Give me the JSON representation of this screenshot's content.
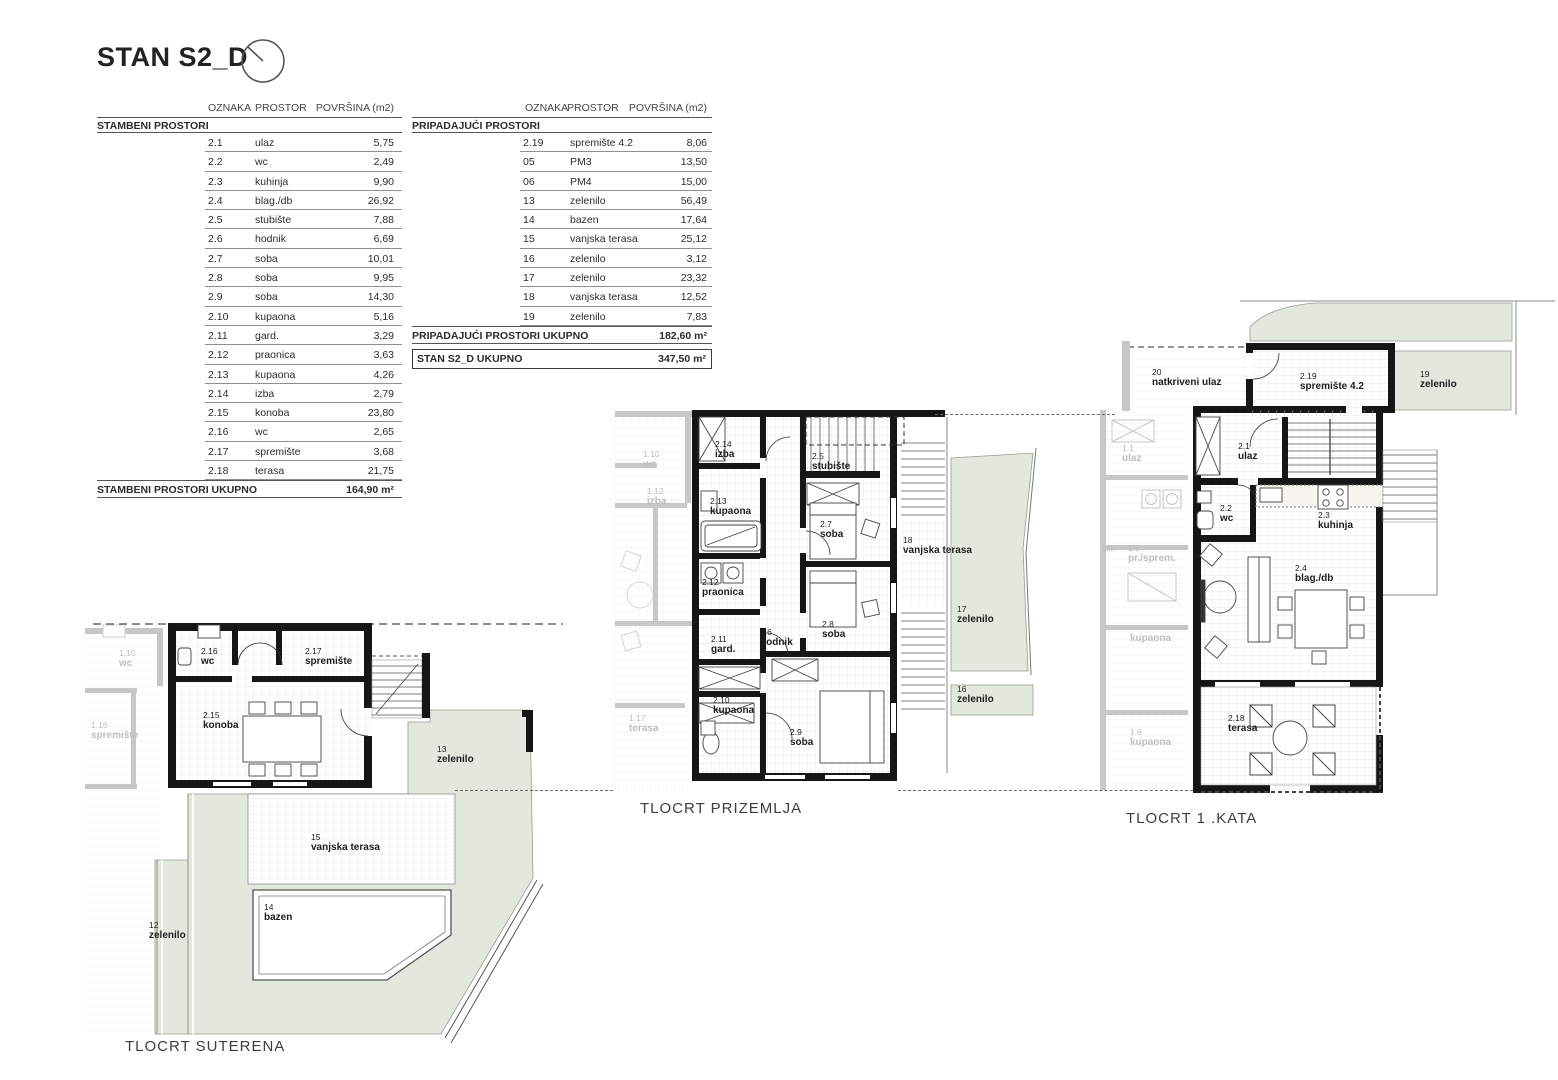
{
  "page": {
    "title": "STAN S2_D"
  },
  "tables": {
    "headers": {
      "oznaka": "OZNAKA",
      "prostor": "PROSTOR",
      "povrsina": "POVRŠINA (m2)"
    },
    "left": {
      "section": "STAMBENI PROSTORI",
      "rows": [
        [
          "2.1",
          "ulaz",
          "5,75"
        ],
        [
          "2.2",
          "wc",
          "2,49"
        ],
        [
          "2.3",
          "kuhinja",
          "9,90"
        ],
        [
          "2.4",
          "blag./db",
          "26,92"
        ],
        [
          "2.5",
          "stubište",
          "7,88"
        ],
        [
          "2.6",
          "hodnik",
          "6,69"
        ],
        [
          "2.7",
          "soba",
          "10,01"
        ],
        [
          "2.8",
          "soba",
          "9,95"
        ],
        [
          "2.9",
          "soba",
          "14,30"
        ],
        [
          "2.10",
          "kupaona",
          "5,16"
        ],
        [
          "2.11",
          "gard.",
          "3,29"
        ],
        [
          "2.12",
          "praonica",
          "3,63"
        ],
        [
          "2.13",
          "kupaona",
          "4,26"
        ],
        [
          "2.14",
          "izba",
          "2,79"
        ],
        [
          "2.15",
          "konoba",
          "23,80"
        ],
        [
          "2.16",
          "wc",
          "2,65"
        ],
        [
          "2.17",
          "spremište",
          "3,68"
        ],
        [
          "2.18",
          "terasa",
          "21,75"
        ]
      ],
      "total_label": "STAMBENI PROSTORI UKUPNO",
      "total_value": "164,90 m²"
    },
    "right": {
      "section": "PRIPADAJUĆI PROSTORI",
      "rows": [
        [
          "2.19",
          "spremište 4.2",
          "8,06"
        ],
        [
          "05",
          "PM3",
          "13,50"
        ],
        [
          "06",
          "PM4",
          "15,00"
        ],
        [
          "13",
          "zelenilo",
          "56,49"
        ],
        [
          "14",
          "bazen",
          "17,64"
        ],
        [
          "15",
          "vanjska terasa",
          "25,12"
        ],
        [
          "16",
          "zelenilo",
          "3,12"
        ],
        [
          "17",
          "zelenilo",
          "23,32"
        ],
        [
          "18",
          "vanjska terasa",
          "12,52"
        ],
        [
          "19",
          "zelenilo",
          "7,83"
        ]
      ],
      "total_label": "PRIPADAJUĆI PROSTORI UKUPNO",
      "total_value": "182,60 m²",
      "grand_label": "STAN S2_D UKUPNO",
      "grand_value": "347,50 m²"
    }
  },
  "plans": {
    "suterena": {
      "title": "TLOCRT SUTERENA",
      "rooms": {
        "wc216": {
          "num": "2.16",
          "name": "wc"
        },
        "sprem217": {
          "num": "2.17",
          "name": "spremište"
        },
        "konoba": {
          "num": "2.15",
          "name": "konoba"
        },
        "zelenilo13": {
          "num": "13",
          "name": "zelenilo"
        },
        "terasa15": {
          "num": "15",
          "name": "vanjska terasa"
        },
        "bazen14": {
          "num": "14",
          "name": "bazen"
        },
        "zelenilo12": {
          "num": "12",
          "name": "zelenilo"
        }
      },
      "faded": {
        "wc115": {
          "num": "1.15",
          "name": "wc"
        },
        "sprem116": {
          "num": "1.16",
          "name": "spremište"
        }
      }
    },
    "prizemlja": {
      "title": "TLOCRT PRIZEMLJA",
      "rooms": {
        "izba214": {
          "num": "2.14",
          "name": "izba"
        },
        "stubiste25": {
          "num": "2.5",
          "name": "stubište"
        },
        "kupaona213": {
          "num": "2.13",
          "name": "kupaona"
        },
        "soba27": {
          "num": "2.7",
          "name": "soba"
        },
        "praonica": {
          "num": "2.12",
          "name": "praonica"
        },
        "soba28": {
          "num": "2.8",
          "name": "soba"
        },
        "gard211": {
          "num": "2.11",
          "name": "gard."
        },
        "hodnik26": {
          "num": "2.6",
          "name": "hodnik"
        },
        "kupaona210": {
          "num": "2.10",
          "name": "kupaona"
        },
        "soba29": {
          "num": "2.9",
          "name": "soba"
        },
        "terasa18": {
          "num": "18",
          "name": "vanjska terasa"
        },
        "zelenilo17": {
          "num": "17",
          "name": "zelenilo"
        },
        "zelenilo16": {
          "num": "16",
          "name": "zelenilo"
        }
      },
      "faded": {
        "wc110": {
          "num": "1.10",
          "name": "wc"
        },
        "izba112": {
          "num": "1.12",
          "name": "izba"
        },
        "terasa117": {
          "num": "1.17",
          "name": "terasa"
        }
      }
    },
    "kata": {
      "title": "TLOCRT 1 .KATA",
      "rooms": {
        "ulaz20": {
          "num": "20",
          "name": "natkriveni ulaz"
        },
        "sprem219": {
          "num": "2.19",
          "name": "spremište 4.2"
        },
        "zelenilo19": {
          "num": "19",
          "name": "zelenilo"
        },
        "ulaz21": {
          "num": "2.1",
          "name": "ulaz"
        },
        "wc22": {
          "num": "2.2",
          "name": "wc"
        },
        "kuhinja23": {
          "num": "2.3",
          "name": "kuhinja"
        },
        "blagdb24": {
          "num": "2.4",
          "name": "blag./db"
        },
        "terasa218": {
          "num": "2.18",
          "name": "terasa"
        }
      },
      "faded": {
        "ulaz11": {
          "num": "1.1",
          "name": "ulaz"
        },
        "hodnik_frag": {
          "num": "lnik",
          "name": ""
        },
        "prsprem18": {
          "num": "1.8",
          "name": "pr./sprem."
        },
        "kupaona_mid": {
          "num": "",
          "name": "kupaona"
        },
        "kupaona16": {
          "num": "1.6",
          "name": "kupaona"
        }
      }
    }
  }
}
